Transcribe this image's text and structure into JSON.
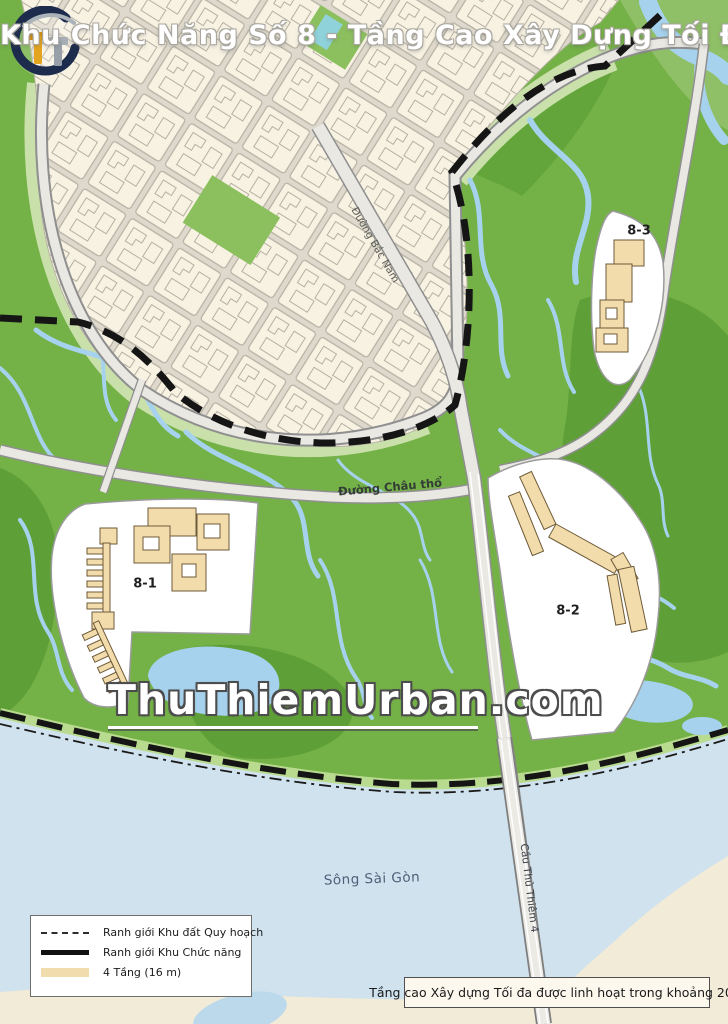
{
  "page": {
    "width": 728,
    "height": 1024
  },
  "title": "Khu Chức Năng Số 8 - Tầng Cao Xây Dựng Tối Đa",
  "watermark": "ThuThiemUrban.com",
  "zones": [
    {
      "id": "8-1",
      "label": "8-1"
    },
    {
      "id": "8-2",
      "label": "8-2"
    },
    {
      "id": "8-3",
      "label": "8-3"
    }
  ],
  "map_labels": {
    "street_north_south": "Đường Bắc Nam",
    "street_east_west": "Đường Châu thổ",
    "river": "Sông Sài Gòn",
    "bridge": "Cầu Thủ Thiêm 4"
  },
  "legend": {
    "items": [
      {
        "label": "Ranh giới Khu đất Quy hoạch",
        "swatch": "dashed-line"
      },
      {
        "label": "Ranh giới Khu Chức năng",
        "swatch": "solid-line"
      },
      {
        "label": "4 Tầng  (16 m)",
        "swatch": "tan-fill"
      }
    ]
  },
  "note": "Tầng cao Xây dựng Tối đa được linh hoạt trong khoảng 20%",
  "colors": {
    "urban_base": "#f6efdf",
    "green_main": "#74b147",
    "green_dark": "#5f9f37",
    "green_pale": "#c9e0ab",
    "channel_blue": "#a6d2ee",
    "river_blue": "#cfe2ee",
    "building_tan": "#f3dcab",
    "boundary_black": "#151515",
    "road_fill": "#e9e8e3",
    "logo_navy": "#1d2b4d",
    "logo_gold": "#d9940f"
  }
}
